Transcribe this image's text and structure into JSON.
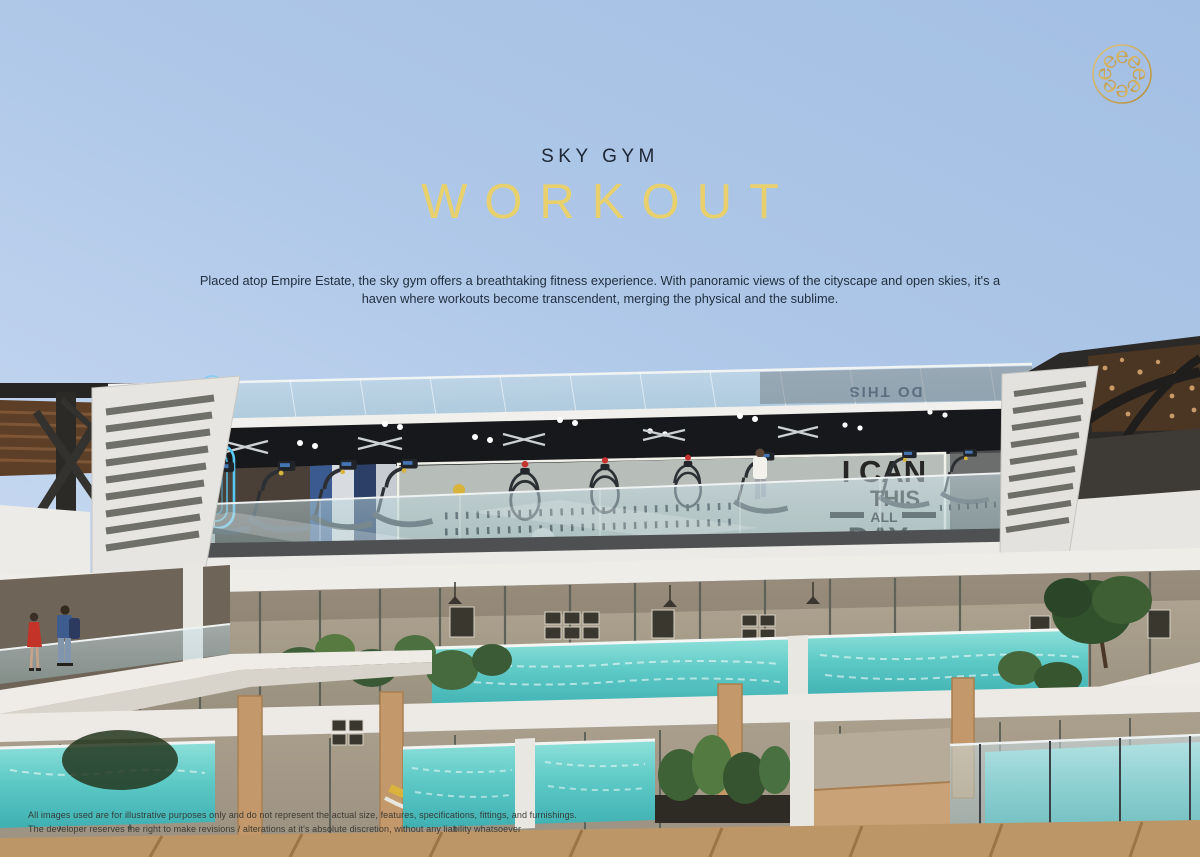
{
  "hero": {
    "eyebrow": "SKY GYM",
    "title": "WORKOUT",
    "description_lines": [
      "Placed atop Empire Estate, the sky gym offers a breathtaking fitness experience. With panoramic views of the cityscape and open skies, it's a",
      "haven where workouts become transcendent, merging the physical and the sublime."
    ]
  },
  "footer": {
    "disclaimer_lines": [
      "All images used are for illustrative purposes only and do not represent the actual size, features, specifications, fittings, and furnishings.",
      "The developer reserves the right to make revisions / alterations at it's absolute discretion, without any liability whatsoever"
    ]
  },
  "logo": {
    "description": "gold spherical monogram of letter e",
    "letter": "e"
  },
  "render": {
    "mural": {
      "line1": "I CAN",
      "line2": "THIS",
      "line3": "ALL",
      "line4": "DAY",
      "star": "★"
    },
    "glass_reflection": {
      "line1": "DO THIS",
      "line2": "I CAN"
    }
  },
  "colors": {
    "title_gold": "#e8d16d",
    "heading_dark": "#1d2634",
    "body_text": "#22303f",
    "logo_gold": "#c9a449",
    "sky_top": "#a3bfe3",
    "sky_bottom": "#d7e3f4",
    "pool_water": "#5ecac6",
    "wood": "#c59e71",
    "neon_blue": "#55c8f2"
  }
}
